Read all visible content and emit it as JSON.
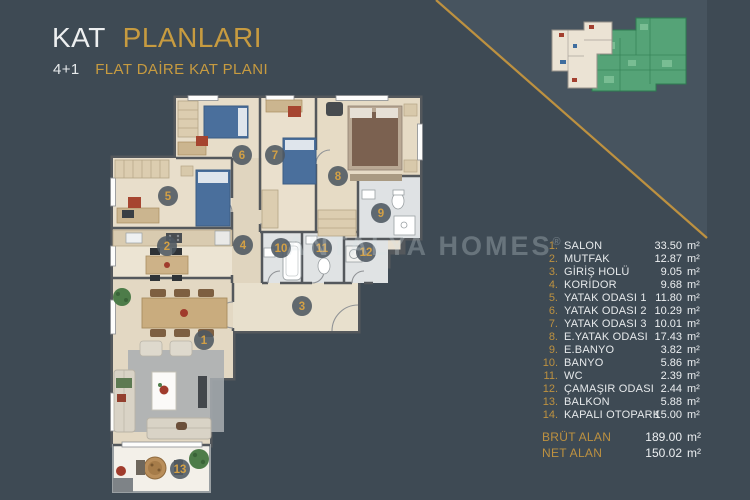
{
  "header": {
    "title_primary": "KAT",
    "title_secondary": "PLANLARI",
    "subtitle_prefix": "4+1",
    "subtitle": "FLAT DAİRE KAT PLANI"
  },
  "watermark": {
    "text": "ANTALYA HOMES",
    "registered": "®"
  },
  "legend": {
    "items": [
      {
        "num": "1.",
        "label": "SALON",
        "value": "33.50",
        "unit": "m²"
      },
      {
        "num": "2.",
        "label": "MUTFAK",
        "value": "12.87",
        "unit": "m²"
      },
      {
        "num": "3.",
        "label": "GİRİŞ HOLÜ",
        "value": "9.05",
        "unit": "m²"
      },
      {
        "num": "4.",
        "label": "KORİDOR",
        "value": "9.68",
        "unit": "m²"
      },
      {
        "num": "5.",
        "label": "YATAK ODASI 1",
        "value": "11.80",
        "unit": "m²"
      },
      {
        "num": "6.",
        "label": "YATAK ODASI 2",
        "value": "10.29",
        "unit": "m²"
      },
      {
        "num": "7.",
        "label": "YATAK ODASI 3",
        "value": "10.01",
        "unit": "m²"
      },
      {
        "num": "8.",
        "label": "E.YATAK ODASI",
        "value": "17.43",
        "unit": "m²"
      },
      {
        "num": "9.",
        "label": "E.BANYO",
        "value": "3.82",
        "unit": "m²"
      },
      {
        "num": "10.",
        "label": "BANYO",
        "value": "5.86",
        "unit": "m²"
      },
      {
        "num": "11.",
        "label": "WC",
        "value": "2.39",
        "unit": "m²"
      },
      {
        "num": "12.",
        "label": "ÇAMAŞIR ODASI",
        "value": "2.44",
        "unit": "m²"
      },
      {
        "num": "13.",
        "label": "BALKON",
        "value": "5.88",
        "unit": "m²"
      },
      {
        "num": "14.",
        "label": "KAPALI OTOPARK",
        "value": "15.00",
        "unit": "m²"
      }
    ],
    "totals": [
      {
        "label": "BRÜT ALAN",
        "value": "189.00",
        "unit": "m²"
      },
      {
        "label": "NET ALAN",
        "value": "150.02",
        "unit": "m²"
      }
    ]
  },
  "plan": {
    "markers": [
      "1",
      "2",
      "3",
      "4",
      "5",
      "6",
      "7",
      "8",
      "9",
      "10",
      "11",
      "12",
      "13"
    ]
  },
  "colors": {
    "background": "#3e4a54",
    "panel_light_triangle": "#47545f",
    "accent_gold": "#c0953f",
    "text_light": "#e8ebed",
    "thumbnail_highlight": "#ebe3d4",
    "thumbnail_mask_green": "#55a377"
  }
}
